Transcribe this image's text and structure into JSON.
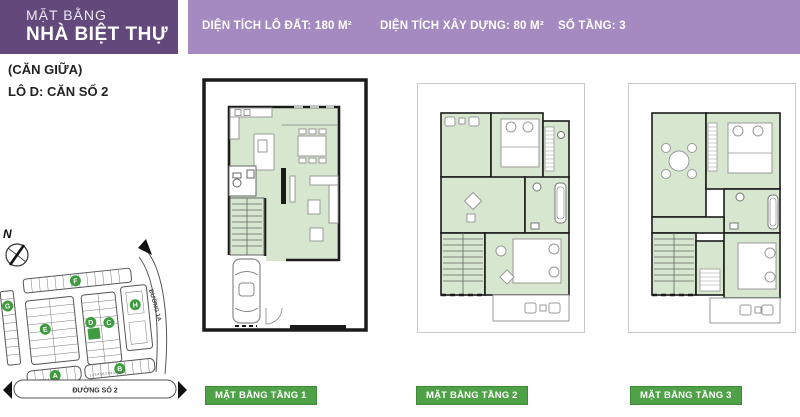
{
  "header": {
    "title_line1": "MẶT BẰNG",
    "title_line2": "NHÀ BIỆT THỰ",
    "subtitle": "(CĂN GIỮA)",
    "lot_label": "LÔ D: CĂN SỐ 2"
  },
  "infobar": {
    "items": [
      {
        "label": "DIỆN TÍCH LÔ ĐẤT: 180 M²"
      },
      {
        "label": "DIỆN TÍCH XÂY DỰNG: 80 M²"
      },
      {
        "label": "SỐ TẦNG: 3"
      }
    ]
  },
  "plans": [
    {
      "label": "MẶT BẰNG TẦNG 1"
    },
    {
      "label": "MẶT BẰNG TẦNG 2"
    },
    {
      "label": "MẶT BẰNG TẦNG 3"
    }
  ],
  "site_map": {
    "compass": "N",
    "blocks": [
      "A",
      "B",
      "C",
      "D",
      "E",
      "F",
      "G",
      "H"
    ],
    "streets": {
      "bottom": "ĐƯỜNG SỐ 2",
      "right": "ĐƯỜNG 1A"
    },
    "lot_numbers_a": "10 9 8 7 6 5 4 3 2 1",
    "lot_numbers_b": "1 2 3 4 5 6 7 8 9 10 11 12"
  },
  "colors": {
    "purple_dark": "#63497b",
    "purple_light": "#a58ac2",
    "green_label": "#4fa148",
    "plan_floor_green": "#d7e6cf",
    "highlight_green": "#3f9b3f",
    "wall_black": "#1b1b1b"
  }
}
